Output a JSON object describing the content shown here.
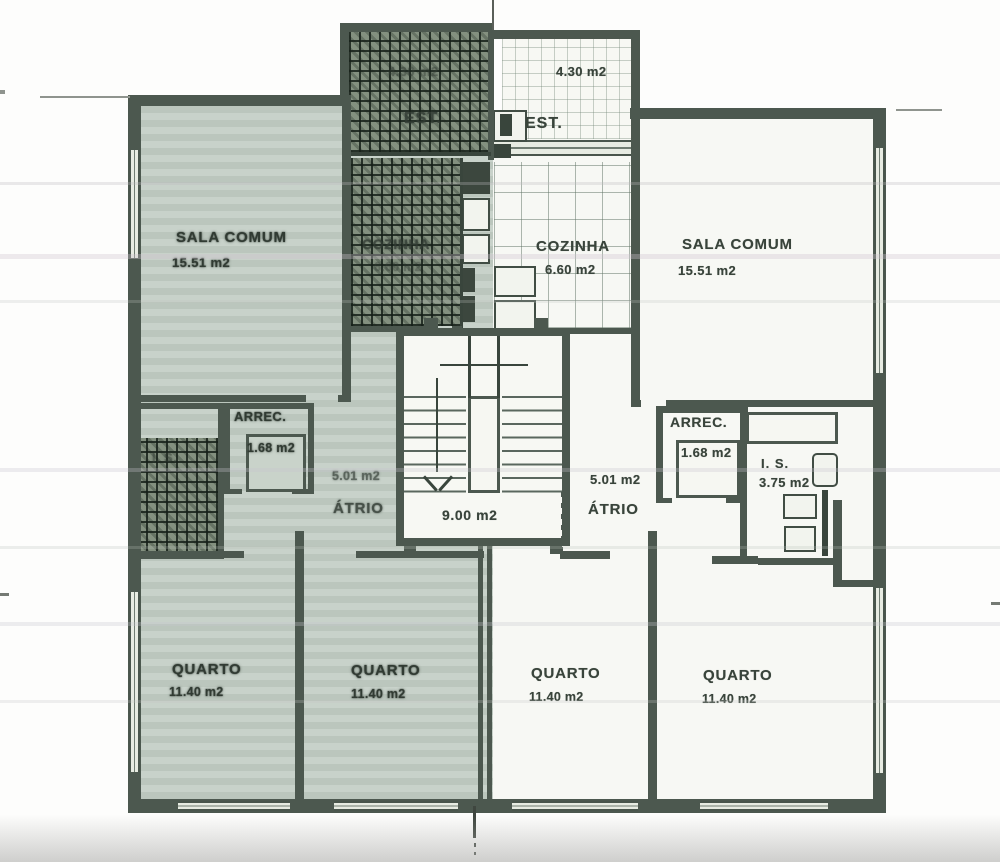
{
  "document": {
    "kind": "scanned apartment floor plan",
    "units_suffix": "m2"
  },
  "colors": {
    "wall": "#4c584f",
    "shaded_apartment_fill": "#c2cdc4",
    "white_apartment_fill": "#f7f8f4",
    "dark_hatch": "#1e2921",
    "label_text": "#39443b",
    "paper": "#fdfdfc"
  },
  "rooms": {
    "est_left": {
      "label": "EST.",
      "area": "4.30 m2"
    },
    "est_right": {
      "label": "EST.",
      "area": "4.30 m2"
    },
    "sala_left": {
      "label": "SALA COMUM",
      "area": "15.51 m2"
    },
    "sala_right": {
      "label": "SALA COMUM",
      "area": "15.51 m2"
    },
    "cozinha_left": {
      "label": "COZINHA",
      "area": "6.60 m2"
    },
    "cozinha_right": {
      "label": "COZINHA",
      "area": "6.60 m2"
    },
    "arrec_left": {
      "label": "ARREC.",
      "area": "1.68 m2"
    },
    "arrec_right": {
      "label": "ARREC.",
      "area": "1.68 m2"
    },
    "atrio_left": {
      "label": "ÁTRIO",
      "area": "5.01 m2"
    },
    "atrio_right": {
      "label": "ÁTRIO",
      "area": "5.01 m2"
    },
    "is_left": {
      "label": "I. S."
    },
    "is_right": {
      "label": "I. S.",
      "area": "3.75 m2"
    },
    "stairwell": {
      "area": "9.00 m2"
    },
    "quarto_1": {
      "label": "QUARTO",
      "area": "11.40 m2"
    },
    "quarto_2": {
      "label": "QUARTO",
      "area": "11.40 m2"
    },
    "quarto_3": {
      "label": "QUARTO",
      "area": "11.40 m2"
    },
    "quarto_4": {
      "label": "QUARTO",
      "area": "11.40 m2"
    }
  }
}
